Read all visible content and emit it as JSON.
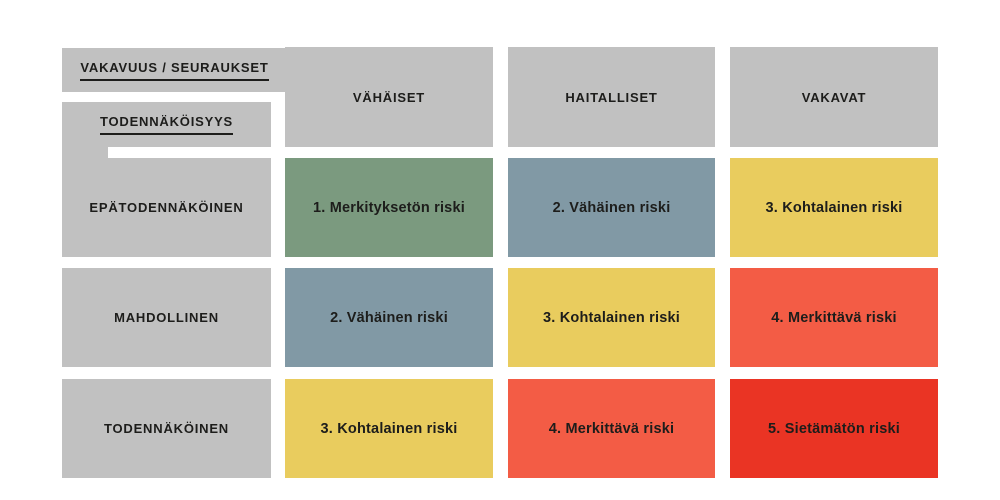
{
  "colors": {
    "header_gray": "#c1c1c1",
    "text": "#1d1d1b",
    "background": "#ffffff",
    "green": "#7b9a7f",
    "blue": "#8199a5",
    "yellow": "#e9cc5e",
    "orange": "#f35c45",
    "red": "#ea3424"
  },
  "matrix": {
    "corner": {
      "severity_label": "VAKAVUUS / SEURAUKSET",
      "probability_label": "TODENNÄKÖISYYS"
    },
    "columns": [
      "VÄHÄISET",
      "HAITALLISET",
      "VAKAVAT"
    ],
    "rows": [
      "EPÄTODENNÄKÖINEN",
      "MAHDOLLINEN",
      "TODENNÄKÖINEN"
    ],
    "cells": [
      [
        {
          "label": "1. Merkityksetön riski",
          "color": "green"
        },
        {
          "label": "2. Vähäinen riski",
          "color": "blue"
        },
        {
          "label": "3. Kohtalainen riski",
          "color": "yellow"
        }
      ],
      [
        {
          "label": "2. Vähäinen riski",
          "color": "blue"
        },
        {
          "label": "3. Kohtalainen riski",
          "color": "yellow"
        },
        {
          "label": "4. Merkittävä riski",
          "color": "orange"
        }
      ],
      [
        {
          "label": "3. Kohtalainen riski",
          "color": "yellow"
        },
        {
          "label": "4. Merkittävä riski",
          "color": "orange"
        },
        {
          "label": "5. Sietämätön riski",
          "color": "red"
        }
      ]
    ]
  }
}
